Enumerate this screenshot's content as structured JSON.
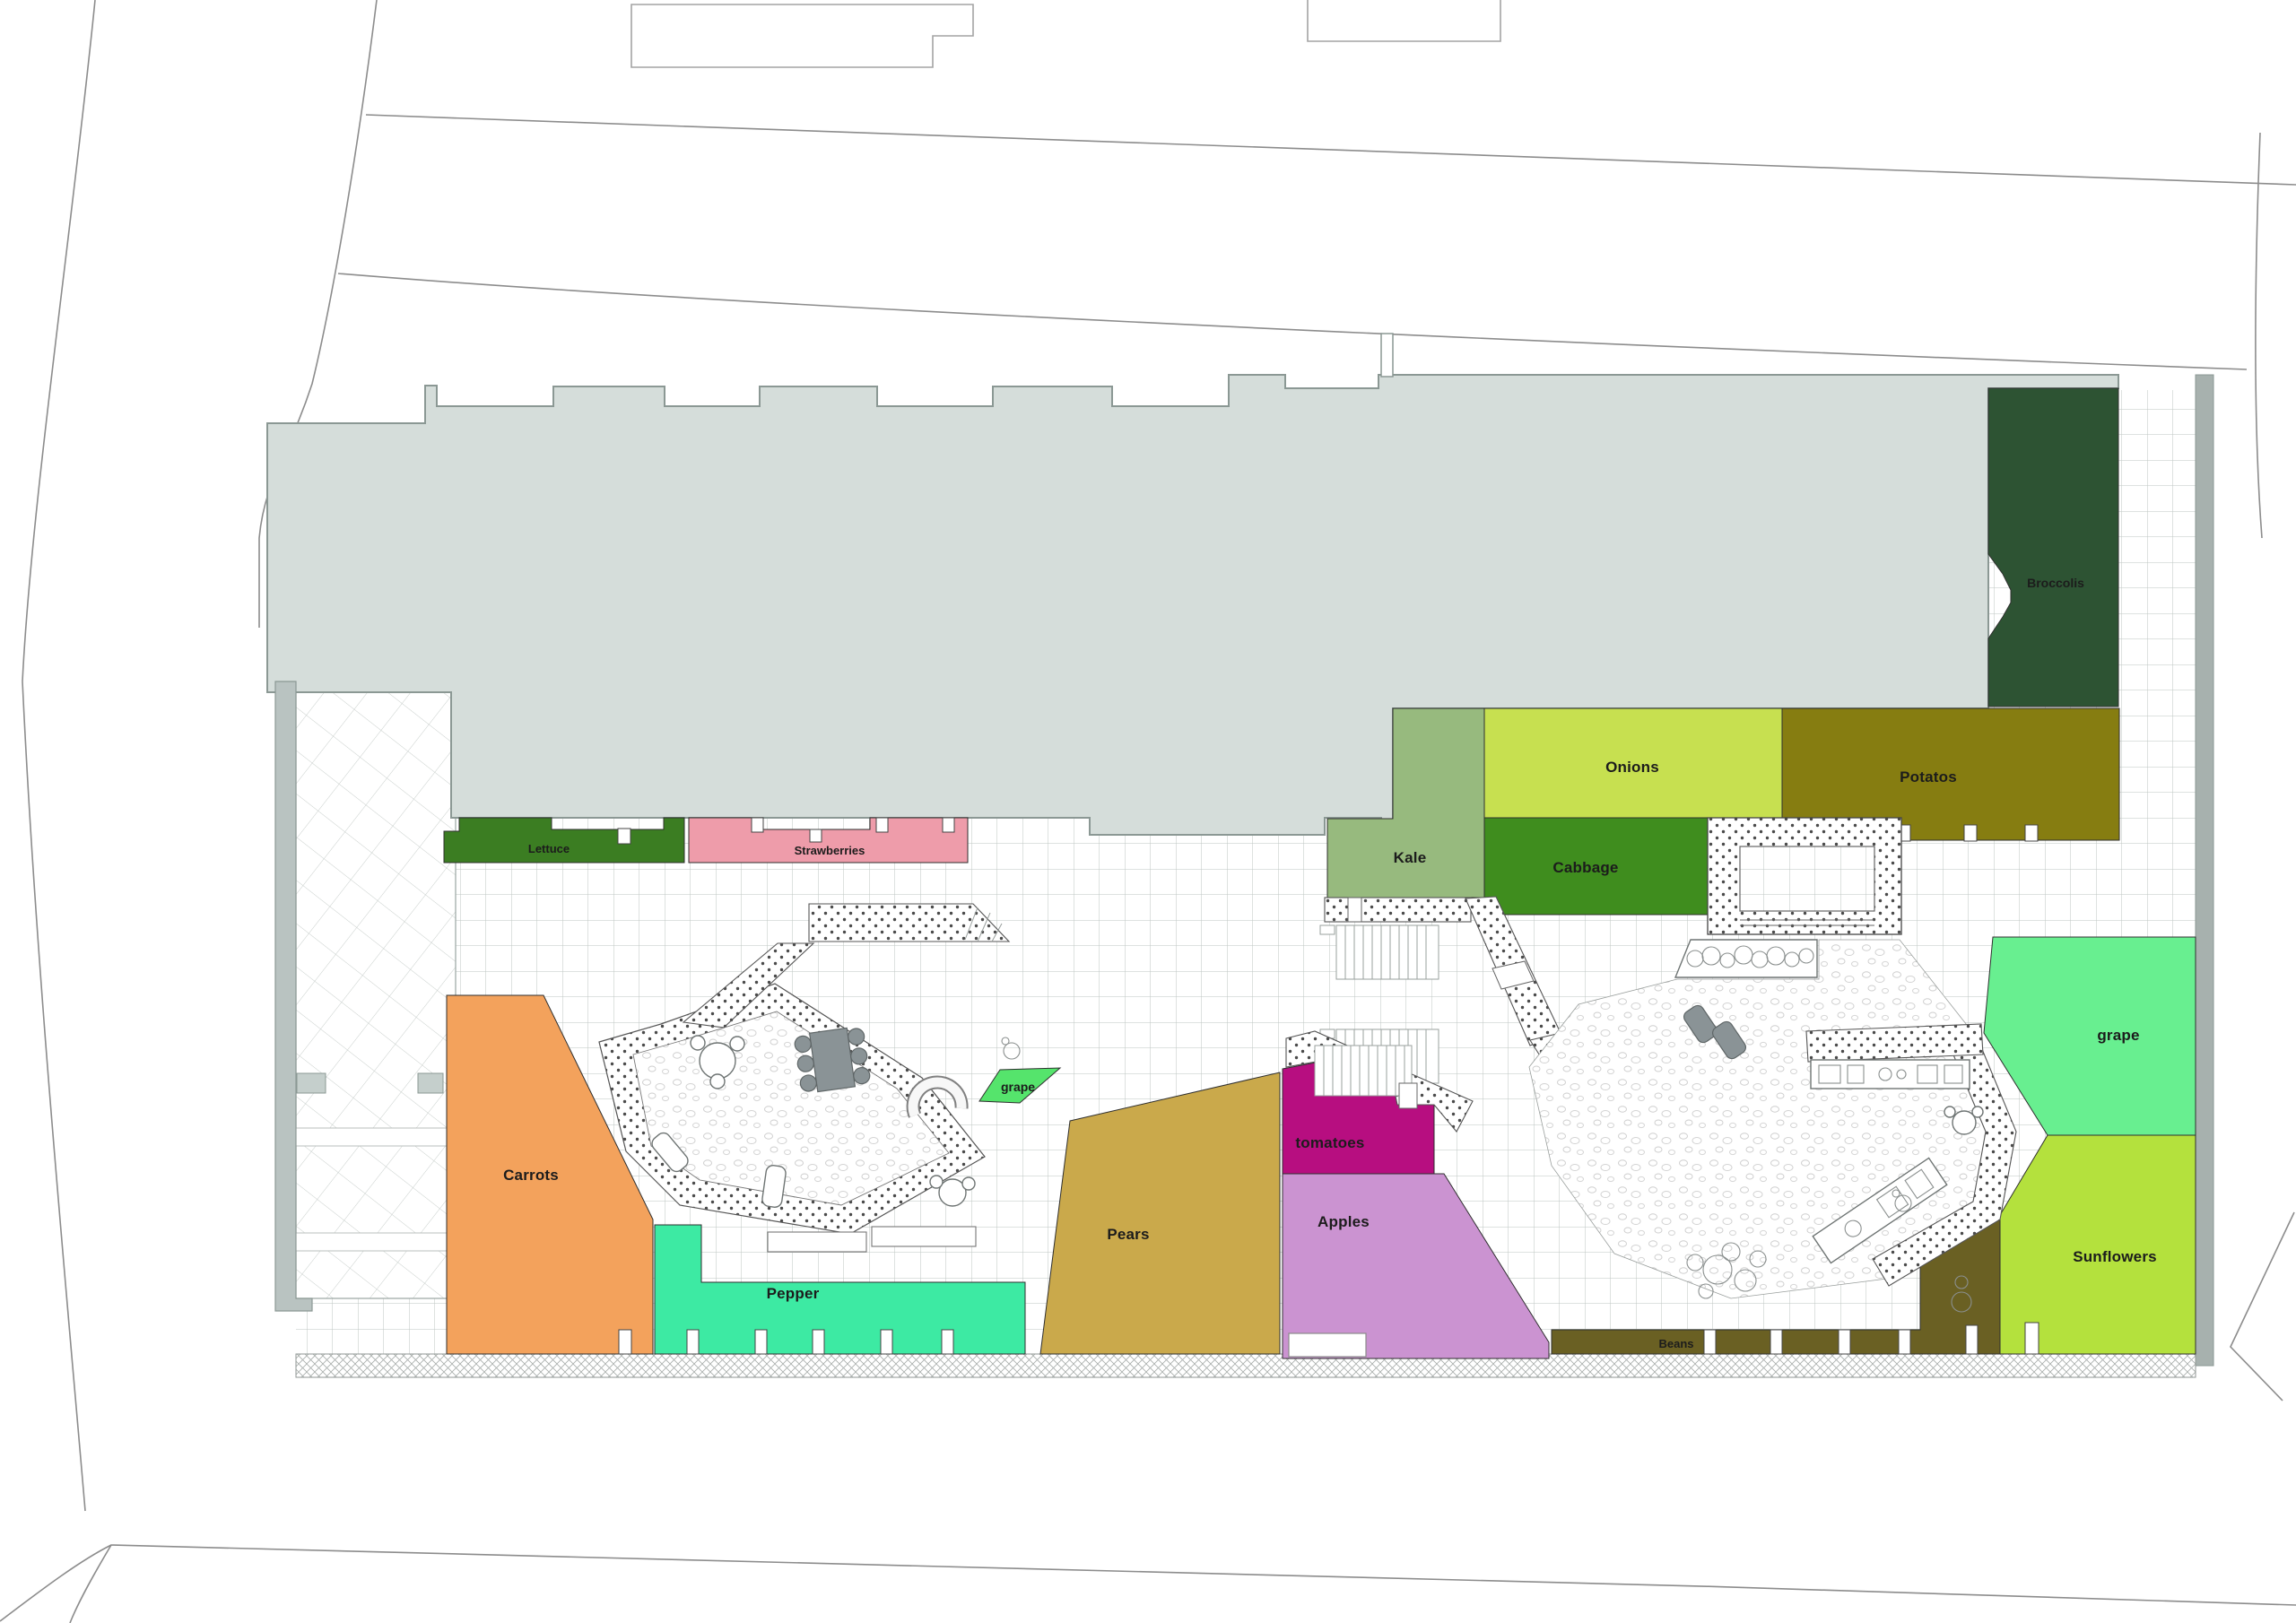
{
  "plan": {
    "type": "rooftop-garden-floor-plan",
    "colors": {
      "building": "#d5ddda",
      "building_edge": "#8b9894",
      "wall": "#b9c3c1",
      "wall_right": "#a7b1ae",
      "road": "#8c8c8c"
    },
    "zones": {
      "broccolis": {
        "label": "Broccolis",
        "color": "#2d5333"
      },
      "onions": {
        "label": "Onions",
        "color": "#c7e050"
      },
      "potatos": {
        "label": "Potatos",
        "color": "#867d11"
      },
      "kale": {
        "label": "Kale",
        "color": "#97ba7e"
      },
      "cabbage": {
        "label": "Cabbage",
        "color": "#3f8d1e"
      },
      "lettuce": {
        "label": "Lettuce",
        "color": "#3b7d22"
      },
      "strawberries": {
        "label": "Strawberries",
        "color": "#ee9caa"
      },
      "carrots": {
        "label": "Carrots",
        "color": "#f3a25c"
      },
      "pepper": {
        "label": "Pepper",
        "color": "#3deaa3"
      },
      "pears": {
        "label": "Pears",
        "color": "#caa94b"
      },
      "tomatoes": {
        "label": "tomatoes",
        "color": "#b70e80"
      },
      "apples": {
        "label": "Apples",
        "color": "#cb93d1"
      },
      "grape_small": {
        "label": "grape",
        "color": "#55e46c"
      },
      "grape": {
        "label": "grape",
        "color": "#68ef90"
      },
      "sunflowers": {
        "label": "Sunflowers",
        "color": "#b4e13d"
      },
      "beans": {
        "label": "Beans",
        "color": "#6a6023"
      }
    }
  }
}
